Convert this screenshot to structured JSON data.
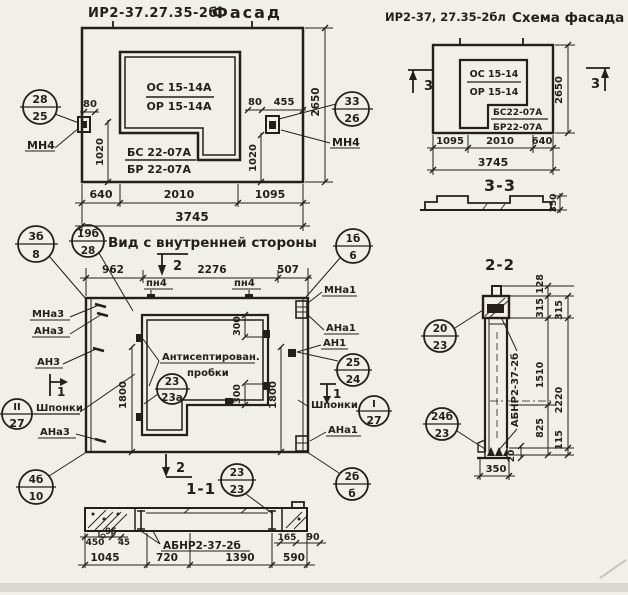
{
  "colors": {
    "ink": "#241f1a",
    "paper": "#f1efe9"
  },
  "facade": {
    "title_code": "ИР2-37.27.35-2б",
    "title_name": "Фасад",
    "win_line1": "ОС 15-14А",
    "win_line2": "ОР 15-14А",
    "panel_line1": "БС 22-07А",
    "panel_line2": "БР 22-07А",
    "callout_left_top": "28",
    "callout_left_bot": "25",
    "callout_right_top": "33",
    "callout_right_bot": "26",
    "anchor_left": "МН4",
    "anchor_right": "МН4",
    "dim_80_l": "80",
    "dim_1020_l": "1020",
    "dim_80_r": "80",
    "dim_455": "455",
    "dim_1020_r": "1020",
    "dim_2650": "2650",
    "dim_640": "640",
    "dim_2010": "2010",
    "dim_1095": "1095",
    "dim_3745": "3745"
  },
  "schema": {
    "title_code": "ИР2-37, 27.35-2бл",
    "title_name": "Схема фасада",
    "win_line1": "ОС 15-14",
    "win_line2": "ОР 15-14",
    "panel_line1": "БС22-07А",
    "panel_line2": "БР22-07А",
    "sec3_left": "3",
    "sec3_right": "3",
    "dim_2650": "2650",
    "dim_1095": "1095",
    "dim_2010": "2010",
    "dim_640": "640",
    "dim_3745": "3745",
    "sec33_title": "3-3",
    "sec33_dim": "350"
  },
  "inner": {
    "title": "Вид с внутренней стороны",
    "c3b8_top": "3б",
    "c3b8_bot": "8",
    "c19b28_top": "19б",
    "c19b28_bot": "28",
    "sec2_top": "2",
    "sec2_bot": "2",
    "dim_962": "962",
    "dim_2276": "2276",
    "dim_507": "507",
    "pn4_l": "пн4",
    "pn4_r": "пн4",
    "c1b6_top": "1б",
    "c1b6_bot": "6",
    "mna1": "МНа1",
    "ana1_top": "АНа1",
    "an1": "АН1",
    "c2524_top": "25",
    "c2524_bot": "24",
    "sec1_right": "1",
    "shponki_r": "Шпонки",
    "cI27_top": "I",
    "cI27_bot": "27",
    "ana1_bot": "АНа1",
    "c2b6_top": "2б",
    "c2b6_bot": "б",
    "mna3": "МНа3",
    "ana3_top": "АНа3",
    "an3": "АН3",
    "sec1_left": "1",
    "cII27_top": "II",
    "cII27_bot": "27",
    "shponki_l": "Шпонки",
    "ana3_bot": "АНа3",
    "c4b10_top": "4б",
    "c4b10_bot": "10",
    "plugs_line1": "Антисептирован.",
    "plugs_line2": "пробки",
    "c23a_top": "23",
    "c23a_bot": "23а",
    "dim300_t": "300",
    "dim300_b": "300",
    "dim1800_l": "1800",
    "dim1800_r": "1800",
    "sec11_title": "1-1",
    "c2323_top": "23",
    "c2323_bot": "23"
  },
  "s11": {
    "label": "АБНР2-37-2б",
    "d450": "450",
    "d95": "95",
    "d45": "45",
    "d165": "165",
    "d90": "90",
    "d1045": "1045",
    "d720": "720",
    "d1390": "1390",
    "d590": "590"
  },
  "s22": {
    "title": "2-2",
    "c2023_top": "20",
    "c2023_bot": "23",
    "c24b23_top": "24б",
    "c24b23_bot": "23",
    "label": "АБНР2-37-2б",
    "d128": "128",
    "d315a": "315",
    "d315b": "315",
    "d1510": "1510",
    "d2220": "2220",
    "d825": "825",
    "d115": "115",
    "d20": "20",
    "d350": "350"
  }
}
